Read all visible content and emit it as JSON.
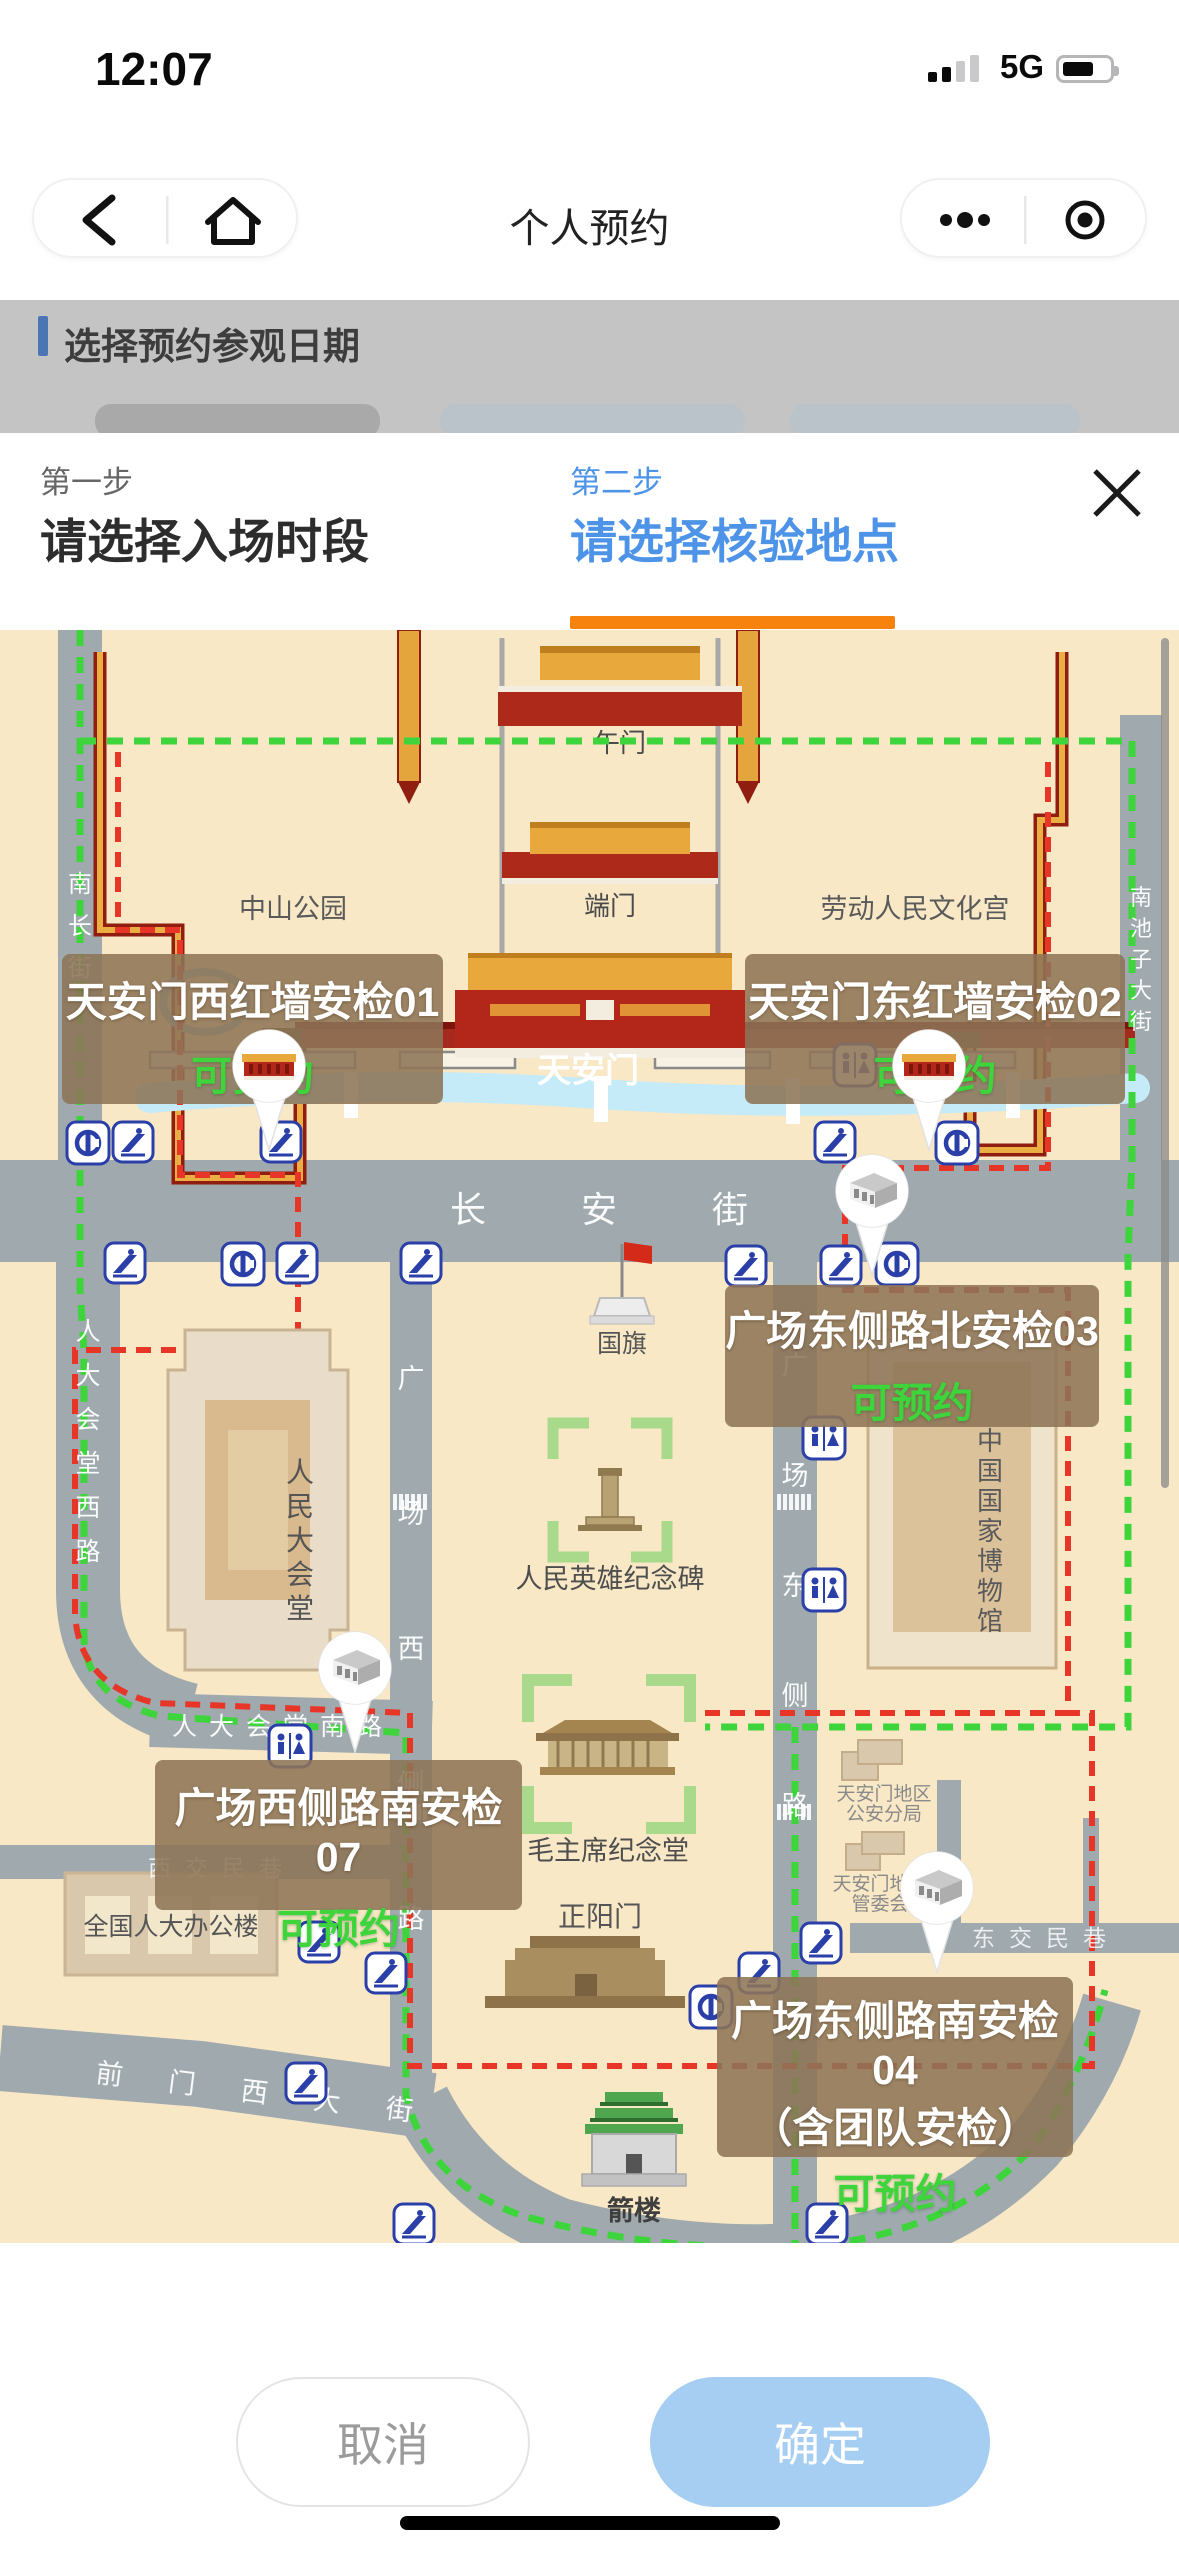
{
  "status": {
    "time": "12:07",
    "network": "5G"
  },
  "nav": {
    "title": "个人预约"
  },
  "dim": {
    "section_title": "选择预约参观日期"
  },
  "sheet": {
    "step1": {
      "step": "第一步",
      "title": "请选择入场时段"
    },
    "step2": {
      "step": "第二步",
      "title": "请选择核验地点"
    },
    "cancel": "取消",
    "confirm": "确定"
  },
  "map": {
    "gates": {
      "wumen": "午门",
      "duanmen": "端门",
      "tiananmen": "天安门",
      "zhengyangmen": "正阳门",
      "jianlou": "箭楼"
    },
    "parks": {
      "zhongshan": "中山公园",
      "culture_palace": "劳动人民文化宫"
    },
    "buildings": {
      "great_hall": "人民大会堂",
      "museum": "中国国家博物馆",
      "monument": "人民英雄纪念碑",
      "memorial": "毛主席纪念堂",
      "npc_office": "全国人大办公楼",
      "flag": "国旗",
      "police_l1": "天安门地区",
      "police_l2": "公安分局",
      "admin_l1": "天安门地区",
      "admin_l2": "管委会"
    },
    "streets": {
      "changan": "长安街",
      "nanchang": "南长街",
      "nanchizi": "南池子大街",
      "west_rd": "广场西侧路",
      "east_rd": "广场东侧路",
      "gh_west": "人大会堂西路",
      "gh_south": "人大会堂南路",
      "xijiaomin": "西交民巷",
      "dongjiaomin": "东交民巷",
      "qianmen": "前门西大街"
    },
    "checkpoints": [
      {
        "name": "天安门西红墙安检01",
        "status": "可预约"
      },
      {
        "name": "天安门东红墙安检02",
        "status": "可预约"
      },
      {
        "name": "广场东侧路北安检03",
        "status": "可预约"
      },
      {
        "name": "广场西侧路南安检07",
        "status": "可预约"
      },
      {
        "name": "广场东侧路南安检04",
        "name_line2": "（含团队安检）",
        "status": "可预约"
      }
    ]
  },
  "colors": {
    "accent_blue": "#4d94e8",
    "accent_orange": "#f7820d",
    "status_green": "#3ed43b",
    "map_bg": "#f8e8c6",
    "road": "#9fa9ae",
    "wall_red": "#a52a1d",
    "wall_gold": "#eaae42",
    "route_green": "#3ed53c",
    "route_red": "#e73527",
    "label_box": "rgba(141,116,86,0.88)",
    "confirm_blue": "#a6cef2"
  }
}
